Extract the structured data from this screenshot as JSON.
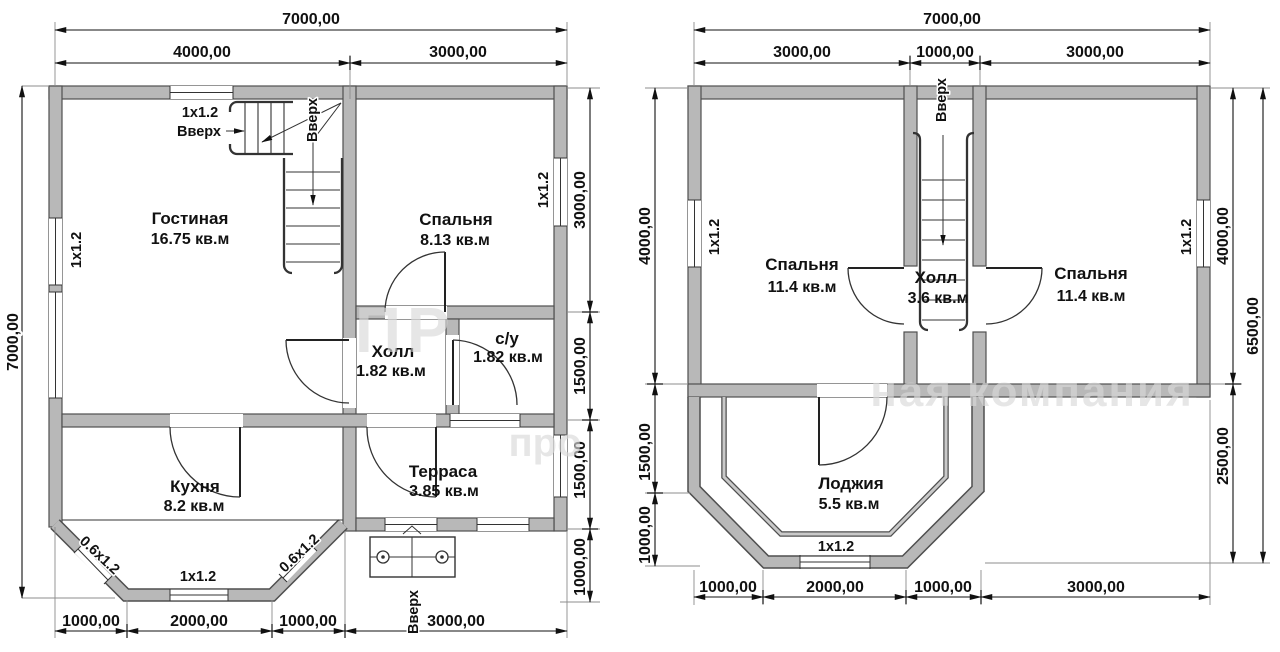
{
  "colors": {
    "wall_fill": "#b8b8b8",
    "line": "#1a1a1a",
    "background": "#ffffff",
    "watermark": "#d9d9d9"
  },
  "watermark": {
    "big_text": "ПР",
    "company_text": "ная компания",
    "partial_text": "про"
  },
  "left_plan": {
    "dims": {
      "top_total": "7000,00",
      "top_seg1": "4000,00",
      "top_seg2": "3000,00",
      "left_total": "7000,00",
      "right_seg1": "3000,00",
      "right_seg2": "1500,00",
      "right_seg3": "1500,00",
      "right_seg4": "1000,00",
      "bottom_seg1": "1000,00",
      "bottom_seg2": "2000,00",
      "bottom_seg3": "1000,00",
      "bottom_seg4": "3000,00"
    },
    "rooms": {
      "living": {
        "name": "Гостиная",
        "area": "16.75 кв.м"
      },
      "bedroom": {
        "name": "Спальня",
        "area": "8.13 кв.м"
      },
      "hall": {
        "name": "Холл",
        "area": "1.82 кв.м"
      },
      "wc": {
        "name": "с/у",
        "area": "1.82 кв.м"
      },
      "kitchen": {
        "name": "Кухня",
        "area": "8.2 кв.м"
      },
      "terrace": {
        "name": "Терраса",
        "area": "3.85 кв.м"
      }
    },
    "windows": {
      "top": "1х1.2",
      "left": "1х1.2",
      "right": "1х1.2",
      "bay_left": "0.6х1.2",
      "bay_bottom": "1х1.2",
      "bay_right": "0.6х1.2"
    },
    "stairs": {
      "up_label": "Вверх",
      "up_rotated": "Вверх"
    },
    "porch": {
      "up_label": "Вверх"
    }
  },
  "right_plan": {
    "dims": {
      "top_total": "7000,00",
      "top_seg1": "3000,00",
      "top_seg2": "1000,00",
      "top_seg3": "3000,00",
      "left_seg1": "4000,00",
      "left_seg2": "1500,00",
      "left_seg3": "1000,00",
      "right_seg1": "4000,00",
      "right_seg2": "2500,00",
      "right_total": "6500,00",
      "bottom_seg1": "1000,00",
      "bottom_seg2": "2000,00",
      "bottom_seg3": "1000,00",
      "bottom_seg4": "3000,00"
    },
    "rooms": {
      "bedroom_left": {
        "name": "Спальня",
        "area": "11.4 кв.м"
      },
      "bedroom_right": {
        "name": "Спальня",
        "area": "11.4 кв.м"
      },
      "hall": {
        "name": "Холл",
        "area": "3.6 кв.м"
      },
      "loggia": {
        "name": "Лоджия",
        "area": "5.5 кв.м"
      }
    },
    "windows": {
      "left": "1х1.2",
      "right": "1х1.2",
      "loggia": "1х1.2"
    },
    "stairs": {
      "up_rotated": "Вверх"
    }
  }
}
